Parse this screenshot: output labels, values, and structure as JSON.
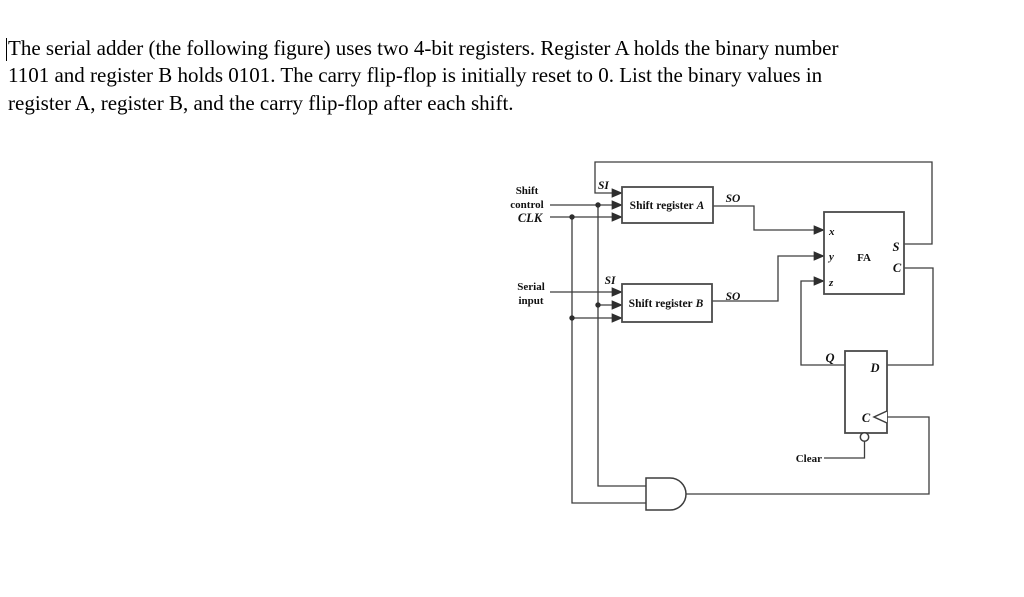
{
  "problem": {
    "line1": "The serial adder (the following figure) uses two 4-bit registers. Register A holds the binary number",
    "line2": "1101 and register B holds 0101. The carry flip-flop is initially reset to 0. List the binary values in",
    "line3": "register A, register B, and the carry flip-flop after each shift."
  },
  "diagram": {
    "left_labels": {
      "shift": "Shift",
      "control": "control",
      "clk": "CLK",
      "serial": "Serial",
      "input": "input"
    },
    "register_a": {
      "label_prefix": "Shift register",
      "label_italic": "A",
      "si": "SI",
      "so": "SO"
    },
    "register_b": {
      "label_prefix": "Shift register",
      "label_italic": "B",
      "si": "SI",
      "so": "SO"
    },
    "full_adder": {
      "label": "FA",
      "in_x": "x",
      "in_y": "y",
      "in_z": "z",
      "out_s": "S",
      "out_c": "C"
    },
    "flip_flop": {
      "out_q": "Q",
      "in_d": "D",
      "clock": "C",
      "clear": "Clear"
    }
  },
  "colors": {
    "wire": "#3d3d3d",
    "box_border": "#4a4a4a",
    "text": "#111111",
    "background": "#ffffff"
  }
}
